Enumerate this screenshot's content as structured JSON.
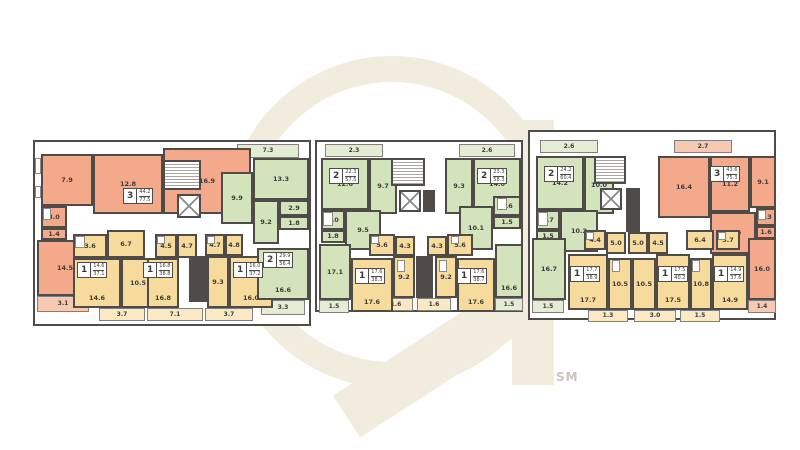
{
  "palette": {
    "wall": "#4f4b49",
    "text": "#3b3b3b",
    "orange": "#f4a98b",
    "orange_light": "#f8c9b2",
    "yellow": "#f6db9d",
    "yellow_light": "#fae9c2",
    "green": "#d3e3bc",
    "green_light": "#e3edd3",
    "watermark": "#f1ecdd"
  },
  "watermark": {
    "label": "SM"
  },
  "sections": [
    {
      "name": "section-left",
      "x": 33,
      "y": 140,
      "w": 278,
      "h": 186,
      "rooms": [
        {
          "x": 6,
          "y": 12,
          "w": 52,
          "h": 52,
          "a": "7.9",
          "c": "o"
        },
        {
          "x": 58,
          "y": 12,
          "w": 70,
          "h": 60,
          "a": "12.8",
          "c": "o"
        },
        {
          "x": 128,
          "y": 6,
          "w": 88,
          "h": 66,
          "a": "16.9",
          "c": "o"
        },
        {
          "x": 6,
          "y": 64,
          "w": 26,
          "h": 22,
          "a": "3.0",
          "c": "o"
        },
        {
          "x": 6,
          "y": 86,
          "w": 26,
          "h": 12,
          "a": "1.4",
          "c": "o"
        },
        {
          "x": 2,
          "y": 98,
          "w": 56,
          "h": 56,
          "a": "14.5",
          "c": "o"
        },
        {
          "x": 2,
          "y": 154,
          "w": 52,
          "h": 16,
          "a": "3.1",
          "c": "ol"
        },
        {
          "x": 38,
          "y": 92,
          "w": 34,
          "h": 24,
          "a": "3.6",
          "c": "y"
        },
        {
          "x": 72,
          "y": 88,
          "w": 38,
          "h": 28,
          "a": "6.7",
          "c": "y"
        },
        {
          "x": 38,
          "y": 116,
          "w": 48,
          "h": 50,
          "a": "14.6",
          "c": "y",
          "lp": "low"
        },
        {
          "x": 86,
          "y": 116,
          "w": 34,
          "h": 50,
          "a": "10.5",
          "c": "y"
        },
        {
          "x": 64,
          "y": 166,
          "w": 46,
          "h": 13,
          "a": "3.7",
          "c": "yl"
        },
        {
          "x": 120,
          "y": 92,
          "w": 22,
          "h": 24,
          "a": "4.5",
          "c": "y"
        },
        {
          "x": 142,
          "y": 92,
          "w": 20,
          "h": 24,
          "a": "4.7",
          "c": "y"
        },
        {
          "x": 112,
          "y": 116,
          "w": 32,
          "h": 50,
          "a": "16.8",
          "c": "y",
          "lp": "low"
        },
        {
          "x": 112,
          "y": 166,
          "w": 56,
          "h": 13,
          "a": "7.1",
          "c": "yl"
        },
        {
          "x": 170,
          "y": 92,
          "w": 20,
          "h": 22,
          "a": "4.7",
          "c": "y"
        },
        {
          "x": 190,
          "y": 92,
          "w": 18,
          "h": 22,
          "a": "4.8",
          "c": "y"
        },
        {
          "x": 172,
          "y": 114,
          "w": 22,
          "h": 52,
          "a": "9.3",
          "c": "y"
        },
        {
          "x": 194,
          "y": 114,
          "w": 44,
          "h": 52,
          "a": "16.0",
          "c": "y",
          "lp": "low"
        },
        {
          "x": 170,
          "y": 166,
          "w": 48,
          "h": 13,
          "a": "3.7",
          "c": "yl"
        },
        {
          "x": 222,
          "y": 106,
          "w": 52,
          "h": 52,
          "a": "16.6",
          "c": "g",
          "lp": "low"
        },
        {
          "x": 226,
          "y": 158,
          "w": 44,
          "h": 15,
          "a": "3.3",
          "c": "gl"
        },
        {
          "x": 186,
          "y": 30,
          "w": 32,
          "h": 52,
          "a": "9.9",
          "c": "g"
        },
        {
          "x": 218,
          "y": 16,
          "w": 56,
          "h": 42,
          "a": "13.3",
          "c": "g"
        },
        {
          "x": 202,
          "y": 2,
          "w": 62,
          "h": 14,
          "a": "7.3",
          "c": "gl"
        },
        {
          "x": 244,
          "y": 58,
          "w": 30,
          "h": 16,
          "a": "2.9",
          "c": "g"
        },
        {
          "x": 218,
          "y": 58,
          "w": 26,
          "h": 44,
          "a": "9.2",
          "c": "g"
        },
        {
          "x": 244,
          "y": 74,
          "w": 30,
          "h": 14,
          "a": "1.8",
          "c": "g"
        }
      ],
      "badges": [
        {
          "x": 88,
          "y": 46,
          "t": "3",
          "l": "44.2",
          "tt": "77.5"
        },
        {
          "x": 228,
          "y": 110,
          "t": "2",
          "l": "29.9",
          "tt": "56.4"
        },
        {
          "x": 42,
          "y": 120,
          "t": "1",
          "l": "14.6",
          "tt": "37.1"
        },
        {
          "x": 108,
          "y": 120,
          "t": "1",
          "l": "16.8",
          "tt": "38.8"
        },
        {
          "x": 198,
          "y": 120,
          "t": "1",
          "l": "16.0",
          "tt": "37.2"
        }
      ],
      "stairs": [
        {
          "x": 128,
          "y": 18,
          "w": 38,
          "h": 30
        }
      ],
      "elevators": [
        {
          "x": 142,
          "y": 52,
          "w": 24,
          "h": 24
        }
      ],
      "solids": [
        {
          "x": 154,
          "y": 114,
          "w": 18,
          "h": 46
        }
      ],
      "fixtures": [
        {
          "x": 0,
          "y": 16,
          "w": 6,
          "h": 16
        },
        {
          "x": 0,
          "y": 44,
          "w": 6,
          "h": 12
        },
        {
          "x": 40,
          "y": 94,
          "w": 10,
          "h": 12
        },
        {
          "x": 8,
          "y": 66,
          "w": 8,
          "h": 12
        },
        {
          "x": 122,
          "y": 94,
          "w": 8,
          "h": 8
        },
        {
          "x": 172,
          "y": 94,
          "w": 8,
          "h": 8
        }
      ]
    },
    {
      "name": "section-middle",
      "x": 315,
      "y": 140,
      "w": 208,
      "h": 172,
      "rooms": [
        {
          "x": 8,
          "y": 2,
          "w": 58,
          "h": 13,
          "a": "2.3",
          "c": "gl"
        },
        {
          "x": 4,
          "y": 16,
          "w": 48,
          "h": 52,
          "a": "12.6",
          "c": "g"
        },
        {
          "x": 52,
          "y": 16,
          "w": 28,
          "h": 56,
          "a": "9.7",
          "c": "g"
        },
        {
          "x": 4,
          "y": 68,
          "w": 24,
          "h": 20,
          "a": "3.0",
          "c": "g"
        },
        {
          "x": 4,
          "y": 88,
          "w": 24,
          "h": 13,
          "a": "1.8",
          "c": "g"
        },
        {
          "x": 28,
          "y": 68,
          "w": 36,
          "h": 40,
          "a": "9.5",
          "c": "g"
        },
        {
          "x": 128,
          "y": 16,
          "w": 28,
          "h": 56,
          "a": "9.3",
          "c": "g"
        },
        {
          "x": 156,
          "y": 16,
          "w": 48,
          "h": 52,
          "a": "14.0",
          "c": "g"
        },
        {
          "x": 142,
          "y": 2,
          "w": 56,
          "h": 13,
          "a": "2.6",
          "c": "gl"
        },
        {
          "x": 176,
          "y": 54,
          "w": 28,
          "h": 20,
          "a": "3.6",
          "c": "g"
        },
        {
          "x": 142,
          "y": 64,
          "w": 34,
          "h": 44,
          "a": "10.1",
          "c": "g"
        },
        {
          "x": 176,
          "y": 74,
          "w": 28,
          "h": 13,
          "a": "1.5",
          "c": "g"
        },
        {
          "x": 52,
          "y": 92,
          "w": 26,
          "h": 22,
          "a": "5.6",
          "c": "y"
        },
        {
          "x": 78,
          "y": 94,
          "w": 20,
          "h": 20,
          "a": "4.3",
          "c": "y"
        },
        {
          "x": 110,
          "y": 94,
          "w": 20,
          "h": 20,
          "a": "4.3",
          "c": "y"
        },
        {
          "x": 130,
          "y": 92,
          "w": 26,
          "h": 22,
          "a": "5.6",
          "c": "y"
        },
        {
          "x": 2,
          "y": 102,
          "w": 32,
          "h": 56,
          "a": "17.1",
          "c": "g"
        },
        {
          "x": 2,
          "y": 158,
          "w": 30,
          "h": 13,
          "a": "1.5",
          "c": "gl"
        },
        {
          "x": 34,
          "y": 116,
          "w": 42,
          "h": 54,
          "a": "17.6",
          "c": "y",
          "lp": "low"
        },
        {
          "x": 76,
          "y": 114,
          "w": 22,
          "h": 42,
          "a": "9.2",
          "c": "y"
        },
        {
          "x": 118,
          "y": 114,
          "w": 22,
          "h": 42,
          "a": "9.2",
          "c": "y"
        },
        {
          "x": 62,
          "y": 156,
          "w": 34,
          "h": 13,
          "a": "1.6",
          "c": "yl"
        },
        {
          "x": 100,
          "y": 156,
          "w": 34,
          "h": 13,
          "a": "1.6",
          "c": "yl"
        },
        {
          "x": 140,
          "y": 116,
          "w": 38,
          "h": 54,
          "a": "17.6",
          "c": "y",
          "lp": "low"
        },
        {
          "x": 178,
          "y": 102,
          "w": 28,
          "h": 54,
          "a": "16.6",
          "c": "g",
          "lp": "low"
        },
        {
          "x": 178,
          "y": 156,
          "w": 28,
          "h": 13,
          "a": "1.5",
          "c": "gl"
        }
      ],
      "badges": [
        {
          "x": 12,
          "y": 26,
          "t": "2",
          "l": "22.3",
          "tt": "57.5"
        },
        {
          "x": 160,
          "y": 26,
          "t": "2",
          "l": "23.3",
          "tt": "58.3"
        },
        {
          "x": 38,
          "y": 126,
          "t": "1",
          "l": "17.6",
          "tt": "38.3"
        },
        {
          "x": 140,
          "y": 126,
          "t": "1",
          "l": "17.6",
          "tt": "38.7"
        }
      ],
      "stairs": [
        {
          "x": 74,
          "y": 16,
          "w": 34,
          "h": 28
        }
      ],
      "elevators": [
        {
          "x": 82,
          "y": 48,
          "w": 22,
          "h": 22
        }
      ],
      "solids": [
        {
          "x": 99,
          "y": 114,
          "w": 17,
          "h": 42
        },
        {
          "x": 106,
          "y": 48,
          "w": 12,
          "h": 22
        }
      ],
      "fixtures": [
        {
          "x": 6,
          "y": 70,
          "w": 10,
          "h": 14
        },
        {
          "x": 180,
          "y": 56,
          "w": 10,
          "h": 12
        },
        {
          "x": 80,
          "y": 118,
          "w": 8,
          "h": 12
        },
        {
          "x": 122,
          "y": 118,
          "w": 8,
          "h": 12
        },
        {
          "x": 54,
          "y": 94,
          "w": 8,
          "h": 8
        },
        {
          "x": 134,
          "y": 94,
          "w": 8,
          "h": 8
        }
      ]
    },
    {
      "name": "section-right",
      "x": 528,
      "y": 130,
      "w": 248,
      "h": 190,
      "rooms": [
        {
          "x": 10,
          "y": 8,
          "w": 58,
          "h": 13,
          "a": "2.6",
          "c": "gl"
        },
        {
          "x": 6,
          "y": 24,
          "w": 48,
          "h": 54,
          "a": "14.2",
          "c": "g"
        },
        {
          "x": 54,
          "y": 24,
          "w": 30,
          "h": 58,
          "a": "10.0",
          "c": "g"
        },
        {
          "x": 6,
          "y": 78,
          "w": 24,
          "h": 20,
          "a": "3.7",
          "c": "g"
        },
        {
          "x": 6,
          "y": 98,
          "w": 24,
          "h": 13,
          "a": "1.5",
          "c": "g"
        },
        {
          "x": 30,
          "y": 78,
          "w": 38,
          "h": 42,
          "a": "10.2",
          "c": "g"
        },
        {
          "x": 144,
          "y": 8,
          "w": 58,
          "h": 13,
          "a": "2.7",
          "c": "ol"
        },
        {
          "x": 128,
          "y": 24,
          "w": 52,
          "h": 62,
          "a": "16.4",
          "c": "o"
        },
        {
          "x": 180,
          "y": 24,
          "w": 40,
          "h": 56,
          "a": "11.2",
          "c": "o"
        },
        {
          "x": 220,
          "y": 24,
          "w": 26,
          "h": 52,
          "a": "9.1",
          "c": "o"
        },
        {
          "x": 180,
          "y": 80,
          "w": 46,
          "h": 42,
          "a": "13.0",
          "c": "o"
        },
        {
          "x": 226,
          "y": 76,
          "w": 20,
          "h": 18,
          "a": "3.3",
          "c": "o"
        },
        {
          "x": 226,
          "y": 94,
          "w": 20,
          "h": 13,
          "a": "1.6",
          "c": "o"
        },
        {
          "x": 2,
          "y": 106,
          "w": 34,
          "h": 62,
          "a": "16.7",
          "c": "g"
        },
        {
          "x": 2,
          "y": 168,
          "w": 32,
          "h": 13,
          "a": "1.5",
          "c": "gl"
        },
        {
          "x": 54,
          "y": 98,
          "w": 22,
          "h": 20,
          "a": "4.4",
          "c": "y"
        },
        {
          "x": 76,
          "y": 100,
          "w": 20,
          "h": 22,
          "a": "5.0",
          "c": "y"
        },
        {
          "x": 98,
          "y": 100,
          "w": 20,
          "h": 22,
          "a": "5.0",
          "c": "y"
        },
        {
          "x": 118,
          "y": 100,
          "w": 20,
          "h": 22,
          "a": "4.5",
          "c": "y"
        },
        {
          "x": 156,
          "y": 98,
          "w": 28,
          "h": 20,
          "a": "6.4",
          "c": "y"
        },
        {
          "x": 186,
          "y": 98,
          "w": 24,
          "h": 20,
          "a": "3.7",
          "c": "y"
        },
        {
          "x": 38,
          "y": 122,
          "w": 40,
          "h": 56,
          "a": "17.7",
          "c": "y",
          "lp": "low"
        },
        {
          "x": 78,
          "y": 126,
          "w": 24,
          "h": 52,
          "a": "10.5",
          "c": "y"
        },
        {
          "x": 102,
          "y": 126,
          "w": 24,
          "h": 52,
          "a": "10.5",
          "c": "y"
        },
        {
          "x": 126,
          "y": 122,
          "w": 34,
          "h": 56,
          "a": "17.5",
          "c": "y",
          "lp": "low"
        },
        {
          "x": 160,
          "y": 126,
          "w": 22,
          "h": 52,
          "a": "10.8",
          "c": "y"
        },
        {
          "x": 182,
          "y": 122,
          "w": 36,
          "h": 56,
          "a": "14.9",
          "c": "y",
          "lp": "low"
        },
        {
          "x": 218,
          "y": 106,
          "w": 28,
          "h": 62,
          "a": "16.0",
          "c": "o"
        },
        {
          "x": 218,
          "y": 168,
          "w": 28,
          "h": 13,
          "a": "1.4",
          "c": "ol"
        },
        {
          "x": 58,
          "y": 178,
          "w": 40,
          "h": 12,
          "a": "1.3",
          "c": "yl"
        },
        {
          "x": 104,
          "y": 178,
          "w": 42,
          "h": 12,
          "a": "3.0",
          "c": "yl"
        },
        {
          "x": 150,
          "y": 178,
          "w": 40,
          "h": 12,
          "a": "1.5",
          "c": "yl"
        }
      ],
      "badges": [
        {
          "x": 14,
          "y": 34,
          "t": "2",
          "l": "24.2",
          "tt": "60.4"
        },
        {
          "x": 180,
          "y": 34,
          "t": "3",
          "l": "43.6",
          "tt": "75.3"
        },
        {
          "x": 40,
          "y": 134,
          "t": "1",
          "l": "17.7",
          "tt": "38.9"
        },
        {
          "x": 128,
          "y": 134,
          "t": "1",
          "l": "17.5",
          "tt": "40.2"
        },
        {
          "x": 184,
          "y": 134,
          "t": "1",
          "l": "14.9",
          "tt": "37.6"
        }
      ],
      "stairs": [
        {
          "x": 64,
          "y": 24,
          "w": 32,
          "h": 28
        }
      ],
      "elevators": [
        {
          "x": 70,
          "y": 56,
          "w": 22,
          "h": 22
        }
      ],
      "solids": [
        {
          "x": 96,
          "y": 56,
          "w": 14,
          "h": 44
        }
      ],
      "fixtures": [
        {
          "x": 8,
          "y": 80,
          "w": 10,
          "h": 14
        },
        {
          "x": 228,
          "y": 78,
          "w": 8,
          "h": 10
        },
        {
          "x": 56,
          "y": 100,
          "w": 8,
          "h": 8
        },
        {
          "x": 188,
          "y": 100,
          "w": 8,
          "h": 8
        },
        {
          "x": 82,
          "y": 128,
          "w": 8,
          "h": 12
        },
        {
          "x": 162,
          "y": 128,
          "w": 8,
          "h": 12
        }
      ]
    }
  ]
}
